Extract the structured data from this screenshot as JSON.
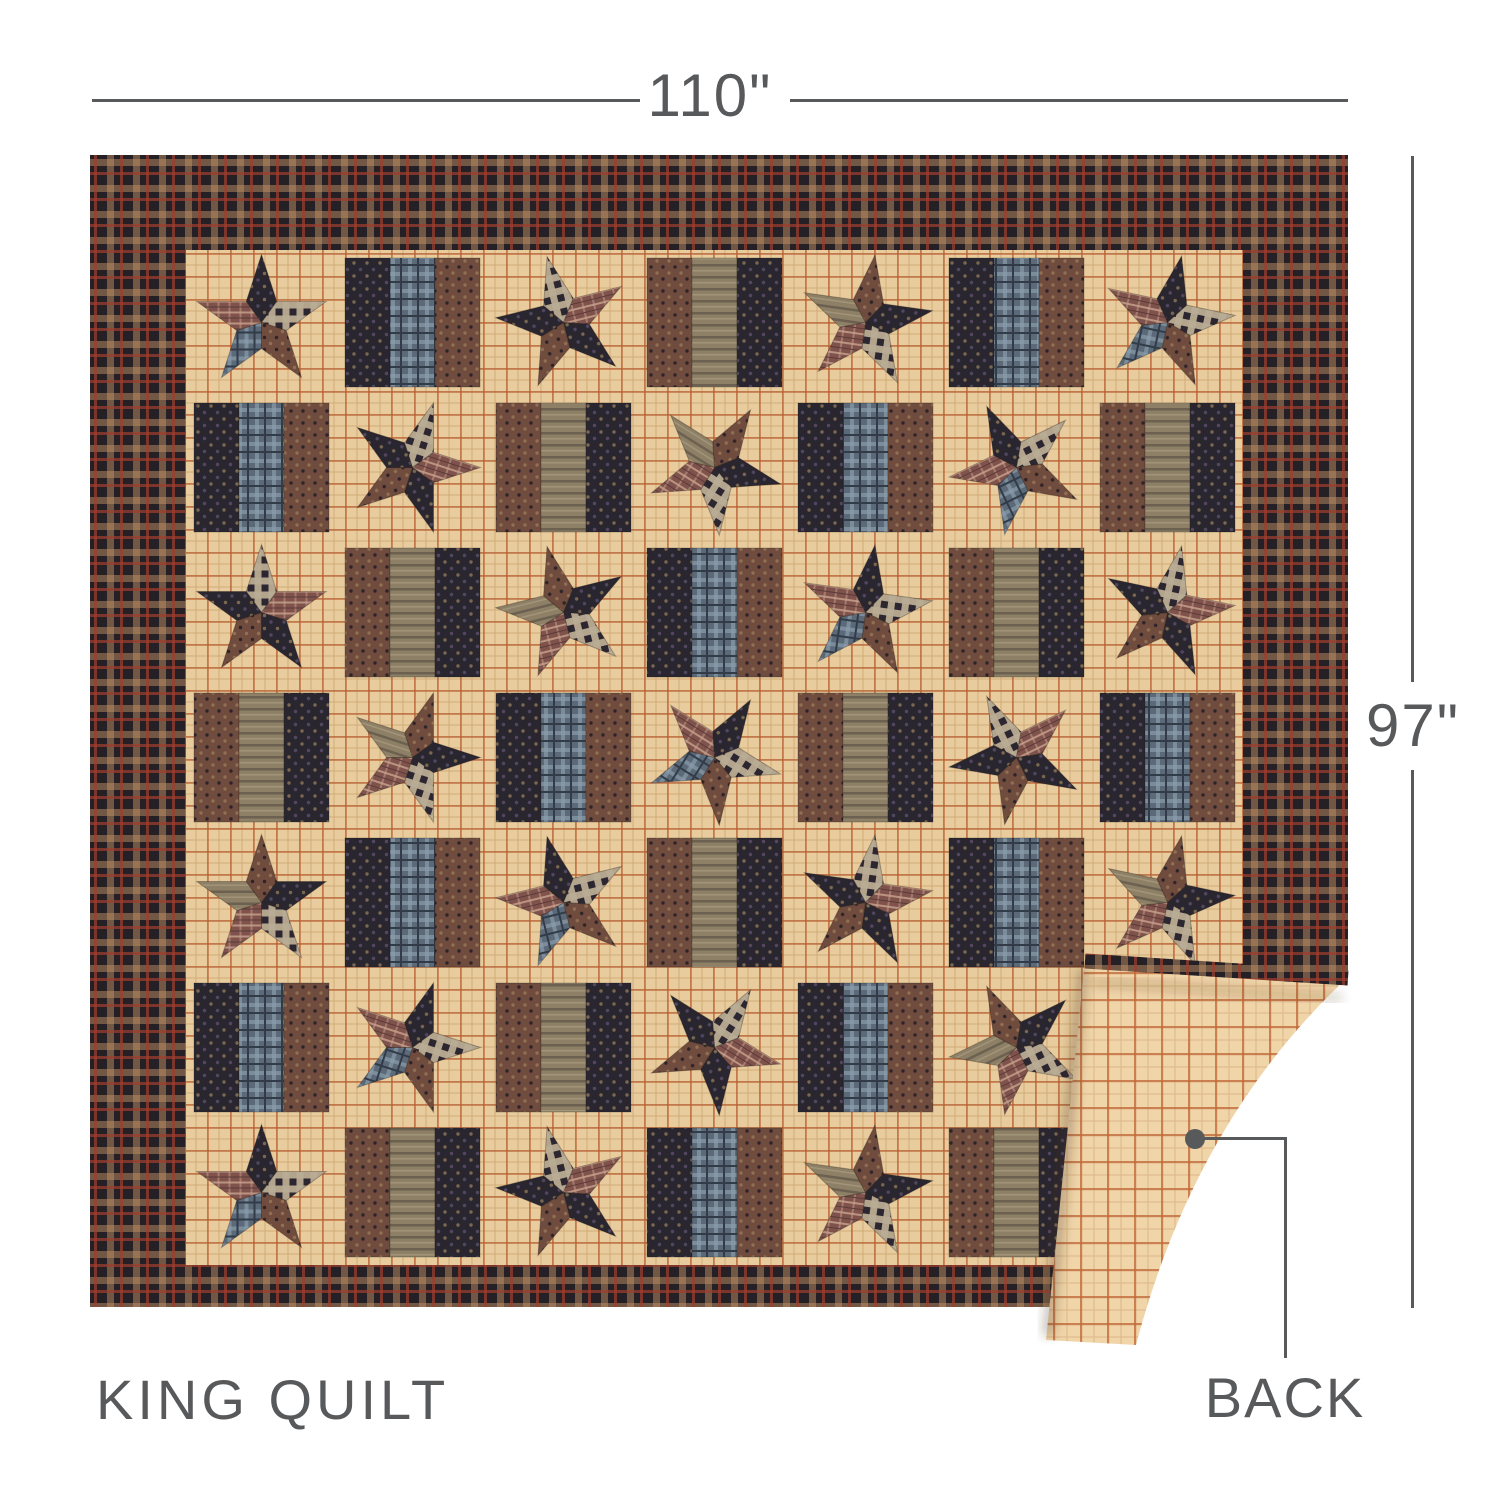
{
  "annotations": {
    "width_label": "110\"",
    "height_label": "97\"",
    "product_label": "KING QUILT",
    "back_label": "BACK"
  },
  "style": {
    "annotation_color": "#58595b",
    "background": "#ffffff",
    "quilt_colors": {
      "border_plaid_base": "#242025",
      "border_plaid_tan": "#bf9064",
      "border_plaid_red": "#a13e2c",
      "field_tan": "#e8cc9d",
      "field_grid_rust": "#b55e31",
      "backing_tan": "#f0d5a9",
      "backing_grid_rust": "#c06a3a",
      "fabric_navy": "#2a2630",
      "fabric_brown": "#6f4c3d",
      "fabric_maroon": "#7f534c",
      "fabric_olive": "#8d8066",
      "fabric_blue_plaid": "#5b6979",
      "gingham_cream": "#e8d8b5",
      "gingham_dark": "#2c2631"
    }
  }
}
